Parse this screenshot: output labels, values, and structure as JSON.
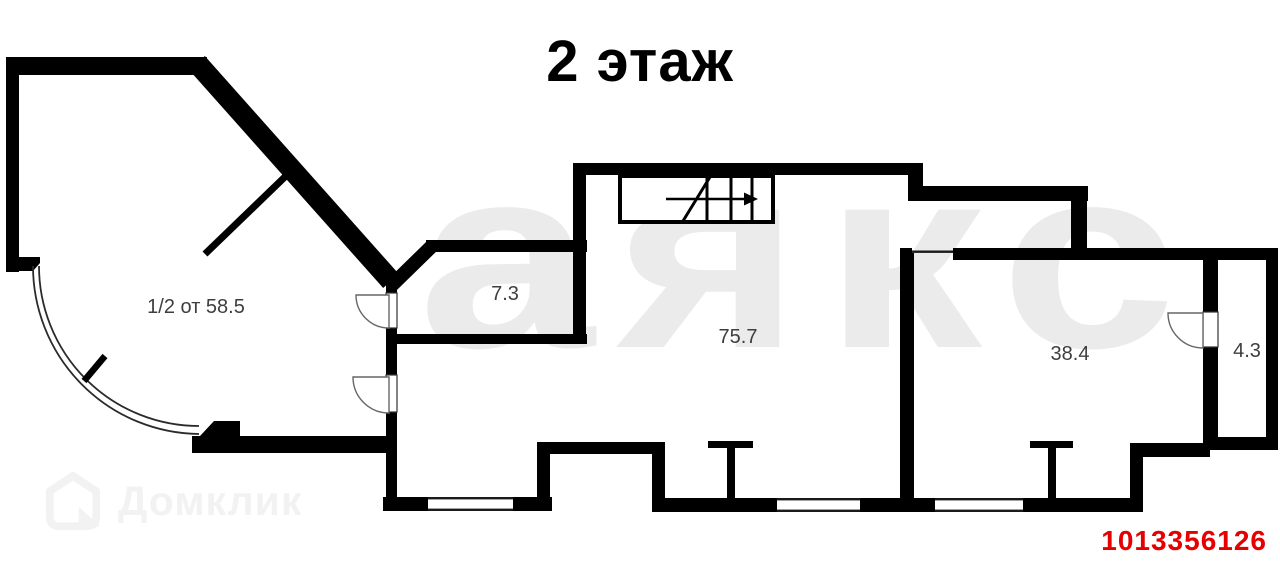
{
  "title": {
    "text": "2 этаж"
  },
  "plan": {
    "rooms": [
      {
        "name": "half-room",
        "area_label": "1/2 от 58.5"
      },
      {
        "name": "room-7-3",
        "area_label": "7.3"
      },
      {
        "name": "room-75-7",
        "area_label": "75.7"
      },
      {
        "name": "room-38-4",
        "area_label": "38.4"
      },
      {
        "name": "room-4-3",
        "area_label": "4.3"
      }
    ]
  },
  "watermarks": {
    "center_text": "аякс",
    "agency_text": "Домклик"
  },
  "listing_id": {
    "value": "1013356126"
  },
  "colors": {
    "background": "#ffffff",
    "walls": "#000000",
    "room_labels": "#3e3e3e",
    "center_watermark": "#ebebeb",
    "agency_watermark": "#f2f2f2",
    "listing_id_red": "#e60000"
  }
}
